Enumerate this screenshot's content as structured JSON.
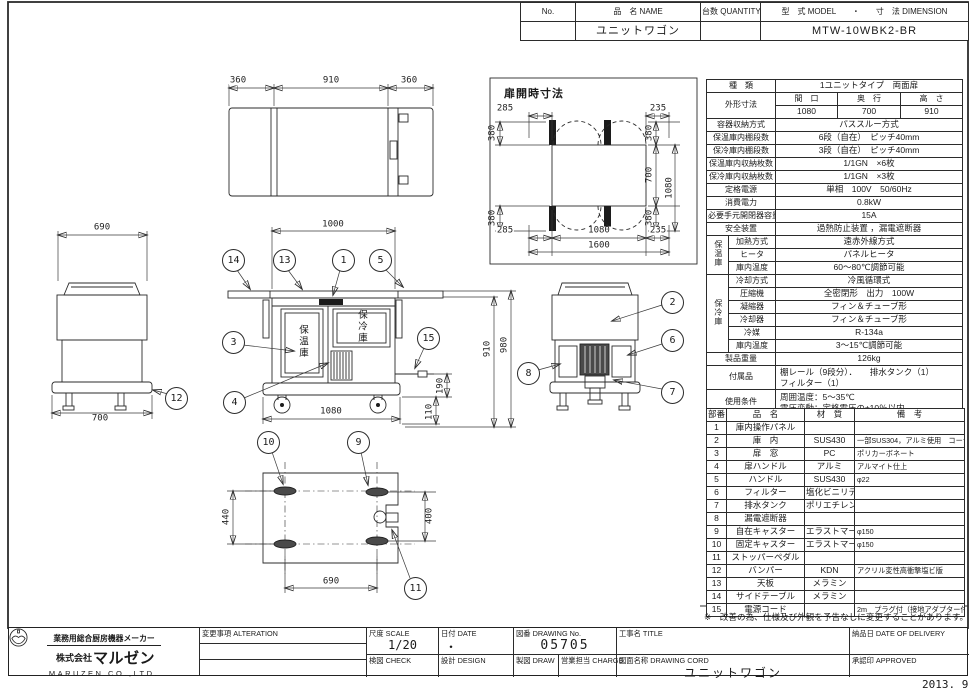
{
  "header": {
    "no_label": "No.",
    "name_label": "品　名 NAME",
    "qty_label": "台数 QUANTITY",
    "model_dim_label": "型　式 MODEL　　・　　寸　法 DIMENSION",
    "name_value": "ユニットワゴン",
    "model_value": "MTW-10WBK2-BR"
  },
  "spec": {
    "kind_label": "種　類",
    "kind_value": "1ユニットタイプ　両面扉",
    "dim_label": "外形寸法",
    "dim_c1": "間　口",
    "dim_c2": "奥　行",
    "dim_c3": "高　さ",
    "dim_v1": "1080",
    "dim_v2": "700",
    "dim_v3": "910",
    "mid": [
      {
        "label": "容器収納方式",
        "value": "パススルー方式"
      },
      {
        "label": "保温庫内棚段数",
        "value": "6段（自在）　ピッチ40mm"
      },
      {
        "label": "保冷庫内棚段数",
        "value": "3段（自在）　ピッチ40mm"
      },
      {
        "label": "保温庫内収納枚数",
        "value": "1/1GN　×6枚"
      },
      {
        "label": "保冷庫内収納枚数",
        "value": "1/1GN　×3枚"
      },
      {
        "label": "定格電源",
        "value": "単相　100V　50/60Hz"
      },
      {
        "label": "消費電力",
        "value": "0.8kW"
      },
      {
        "label": "必要手元開閉器容量",
        "value": "15A"
      },
      {
        "label": "安全装置",
        "value": "過熱防止装置 ，漏電遮断器"
      }
    ],
    "hot_label": "保温庫",
    "hot": [
      {
        "label": "加熱方式",
        "value": "遠赤外線方式"
      },
      {
        "label": "ヒータ",
        "value": "パネルヒータ"
      },
      {
        "label": "庫内温度",
        "value": "60～80℃調節可能"
      }
    ],
    "cold_label": "保冷庫",
    "cold": [
      {
        "label": "冷却方式",
        "value": "冷風循環式"
      },
      {
        "label": "圧縮機",
        "value": "全密閉形　出力　100W"
      },
      {
        "label": "凝縮器",
        "value": "フィン＆チューブ形"
      },
      {
        "label": "冷却器",
        "value": "フィン＆チューブ形"
      },
      {
        "label": "冷媒",
        "value": "R-134a"
      },
      {
        "label": "庫内温度",
        "value": "3～15℃調節可能"
      }
    ],
    "weight_label": "製品重量",
    "weight_value": "126kg",
    "acc_label": "付属品",
    "acc_line1": "棚レール（9段分）．　　排水タンク（1）",
    "acc_line2": "フィルター（1）",
    "use_label": "使用条件",
    "use_line1": "周囲温度：5～35℃",
    "use_line2": "電圧変動：定格電圧の±10％以内"
  },
  "parts": {
    "headers": [
      "部番",
      "品　名",
      "材　質",
      "備　考"
    ],
    "rows": [
      {
        "no": "1",
        "name": "庫内操作パネル",
        "material": "",
        "note": ""
      },
      {
        "no": "2",
        "name": "庫　内",
        "material": "SUS430",
        "note": "一部SUS304，アルミ使用　コーナー部R加工"
      },
      {
        "no": "3",
        "name": "扉　窓",
        "material": "PC",
        "note": "ポリカーボネート"
      },
      {
        "no": "4",
        "name": "扉ハンドル",
        "material": "アルミ",
        "note": "アルマイト仕上"
      },
      {
        "no": "5",
        "name": "ハンドル",
        "material": "SUS430",
        "note": "φ22"
      },
      {
        "no": "6",
        "name": "フィルター",
        "material": "塩化ビニリデン",
        "note": ""
      },
      {
        "no": "7",
        "name": "排水タンク",
        "material": "ポリエチレン",
        "note": ""
      },
      {
        "no": "8",
        "name": "漏電遮断器",
        "material": "",
        "note": ""
      },
      {
        "no": "9",
        "name": "自在キャスター",
        "material": "エラストマー",
        "note": "φ150"
      },
      {
        "no": "10",
        "name": "固定キャスター",
        "material": "エラストマー",
        "note": "φ150"
      },
      {
        "no": "11",
        "name": "ストッパーペダル",
        "material": "",
        "note": ""
      },
      {
        "no": "12",
        "name": "バンパー",
        "material": "KDN",
        "note": "アクリル変性高衝撃塩ビ版"
      },
      {
        "no": "13",
        "name": "天板",
        "material": "メラミン",
        "note": ""
      },
      {
        "no": "14",
        "name": "サイドテーブル",
        "material": "メラミン",
        "note": ""
      },
      {
        "no": "15",
        "name": "電源コード",
        "material": "",
        "note": "2m　プラグ付（接地アダプター付）"
      }
    ]
  },
  "note": "※　改善の為、仕様及び外観を予告なしに変更することがあります。",
  "drawing": {
    "top_view_dims": [
      "360",
      "910",
      "360"
    ],
    "door_detail": {
      "title": "扉開時寸法",
      "t285": "285",
      "t235": "235",
      "l380a": "380",
      "l380b": "380",
      "r380a": "380",
      "r700": "700",
      "r380b": "380",
      "v1080": "1080",
      "b285": "285",
      "b1080": "1080",
      "b235": "235",
      "b1600": "1600"
    },
    "front": {
      "d1000": "1000",
      "d1080": "1080",
      "d910": "910",
      "d980": "980",
      "d190": "190",
      "d110": "110",
      "hot": "保温庫",
      "cold": "保冷庫"
    },
    "left": {
      "d690": "690",
      "d700": "700"
    },
    "bottom": {
      "d440": "440",
      "d400": "400",
      "d690": "690"
    },
    "balloon_numbers": [
      "14",
      "13",
      "1",
      "5",
      "3",
      "4",
      "15",
      "12",
      "2",
      "6",
      "8",
      "7",
      "10",
      "9",
      "11"
    ]
  },
  "titleblock": {
    "maker_tagline": "業務用総合厨房機器メーカー",
    "company_prefix": "株式会社",
    "company_name": "マルゼン",
    "company_en": "MARUZEN CO.,LTD.",
    "alteration_label": "変更事項 ALTERATION",
    "scale_label": "尺度 SCALE",
    "scale_value": "1/20",
    "date_label": "日付 DATE",
    "date_value": "・",
    "check_label": "検図 CHECK",
    "design_label": "設計 DESIGN",
    "drawno_label": "図番 DRAWING No.",
    "drawno_value": "05705",
    "draw_label": "製図 DRAW",
    "charge_label": "営業担当 CHARGE",
    "title_label": "工事名 TITLE",
    "dwgname_label": "図面名称 DRAWING CORD",
    "dwgname_value": "ユニットワゴン",
    "delivery_label": "納品日 DATE OF DELIVERY",
    "approved_label": "承認印 APPROVED",
    "date_stamp": "2013. 9"
  }
}
